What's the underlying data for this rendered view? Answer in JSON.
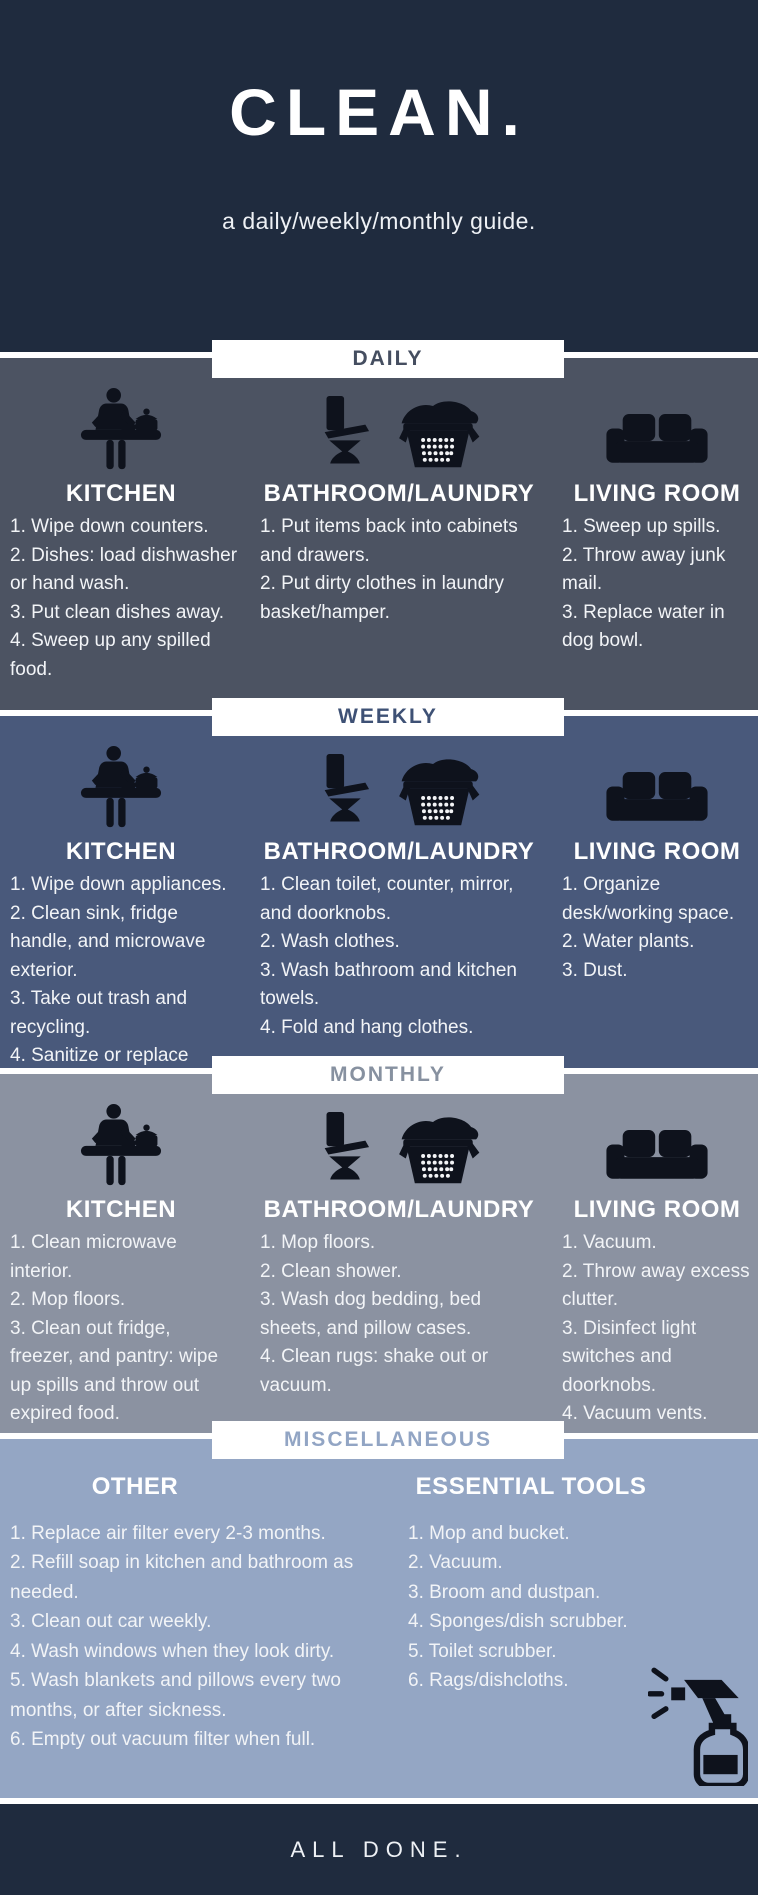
{
  "header": {
    "title": "CLEAN.",
    "subtitle": "a daily/weekly/monthly guide."
  },
  "colors": {
    "header_bg": "#1f2b3e",
    "daily_bg": "#4c5362",
    "weekly_bg": "#49597b",
    "monthly_bg": "#8b92a1",
    "misc_bg": "#94a6c4",
    "banner_bg": "#ffffff",
    "daily_label": "#454e60",
    "weekly_label": "#3e5175",
    "monthly_label": "#8791a0",
    "misc_label": "#92a5c4",
    "body_text": "#f2f4f7",
    "icon_color": "#0e121c",
    "footer_bg": "#1f2b3e"
  },
  "sections": [
    {
      "label": "DAILY",
      "columns": [
        {
          "icon": "cooking-table-icon",
          "title": "KITCHEN",
          "items": [
            "1. Wipe down counters.",
            "2. Dishes: load dishwasher or hand wash.",
            "3. Put clean dishes away.",
            "4. Sweep up any spilled food."
          ]
        },
        {
          "icon": "toilet-and-laundry-basket-icon",
          "title": "BATHROOM/LAUNDRY",
          "items": [
            "1. Put items back into cabinets and drawers.",
            "2. Put dirty clothes in laundry basket/hamper."
          ]
        },
        {
          "icon": "couch-icon",
          "title": "LIVING ROOM",
          "items": [
            "1. Sweep up spills.",
            "2. Throw away junk mail.",
            "3. Replace water in dog bowl."
          ]
        }
      ]
    },
    {
      "label": "WEEKLY",
      "columns": [
        {
          "icon": "cooking-table-icon",
          "title": "KITCHEN",
          "items": [
            "1. Wipe down appliances.",
            "2. Clean sink, fridge handle, and microwave exterior.",
            "3. Take out trash and recycling.",
            "4. Sanitize or replace sponges."
          ]
        },
        {
          "icon": "toilet-and-laundry-basket-icon",
          "title": "BATHROOM/LAUNDRY",
          "items": [
            "1. Clean toilet, counter, mirror, and doorknobs.",
            "2. Wash clothes.",
            "3. Wash bathroom and kitchen towels.",
            "4. Fold and hang clothes."
          ]
        },
        {
          "icon": "couch-icon",
          "title": "LIVING ROOM",
          "items": [
            "1. Organize desk/working space.",
            "2. Water plants.",
            "3. Dust."
          ]
        }
      ]
    },
    {
      "label": "MONTHLY",
      "columns": [
        {
          "icon": "cooking-table-icon",
          "title": "KITCHEN",
          "items": [
            "1. Clean microwave interior.",
            "2. Mop floors.",
            "3. Clean out fridge, freezer, and pantry: wipe up spills and throw out expired food."
          ]
        },
        {
          "icon": "toilet-and-laundry-basket-icon",
          "title": "BATHROOM/LAUNDRY",
          "items": [
            "1. Mop floors.",
            "2. Clean shower.",
            "3. Wash dog bedding, bed sheets, and pillow cases.",
            "4. Clean rugs: shake out or vacuum."
          ]
        },
        {
          "icon": "couch-icon",
          "title": "LIVING ROOM",
          "items": [
            "1. Vacuum.",
            "2. Throw away excess clutter.",
            "3. Disinfect light switches and doorknobs.",
            "4. Vacuum vents."
          ]
        }
      ]
    }
  ],
  "misc": {
    "label": "MISCELLANEOUS",
    "other": {
      "title": "OTHER",
      "items": [
        "1. Replace air filter every 2-3 months.",
        "2. Refill soap in kitchen and bathroom as needed.",
        "3. Clean out car weekly.",
        "4. Wash windows when they look dirty.",
        "5. Wash blankets and pillows every two months, or after sickness.",
        "6. Empty out vacuum filter when full."
      ]
    },
    "tools": {
      "title": "ESSENTIAL TOOLS",
      "icon": "spray-bottle-icon",
      "items": [
        "1. Mop and bucket.",
        "2. Vacuum.",
        "3. Broom and dustpan.",
        "4. Sponges/dish scrubber.",
        "5. Toilet scrubber.",
        "6. Rags/dishcloths."
      ]
    }
  },
  "footer": {
    "text": "ALL DONE."
  }
}
